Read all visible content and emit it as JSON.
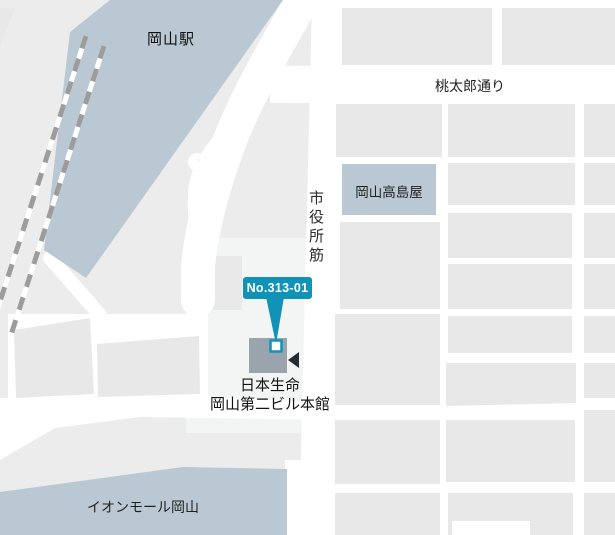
{
  "map": {
    "station_label": "岡山駅",
    "momotaro_road_label": "桃太郎通り",
    "shiyakusho_road_label": "市役所筋",
    "takashimaya_label": "岡山高島屋",
    "aeon_mall_label": "イオンモール岡山",
    "badge_label": "No.313-01",
    "target_building": {
      "name_line1": "日本生命",
      "name_line2": "岡山第二ビル本館"
    }
  },
  "colors": {
    "background": "#ececec",
    "road": "#ffffff",
    "block": "#e8e8e8",
    "plaza": "#f3f4f4",
    "landmark": "#b9c8d2",
    "target_building_fill": "#99a4ac",
    "accent": "#1193b8",
    "marker_fill": "#ffffff",
    "direction_arrow": "#232d35",
    "railway": "#9c9c9c",
    "label_text": "#1c1c1c"
  }
}
